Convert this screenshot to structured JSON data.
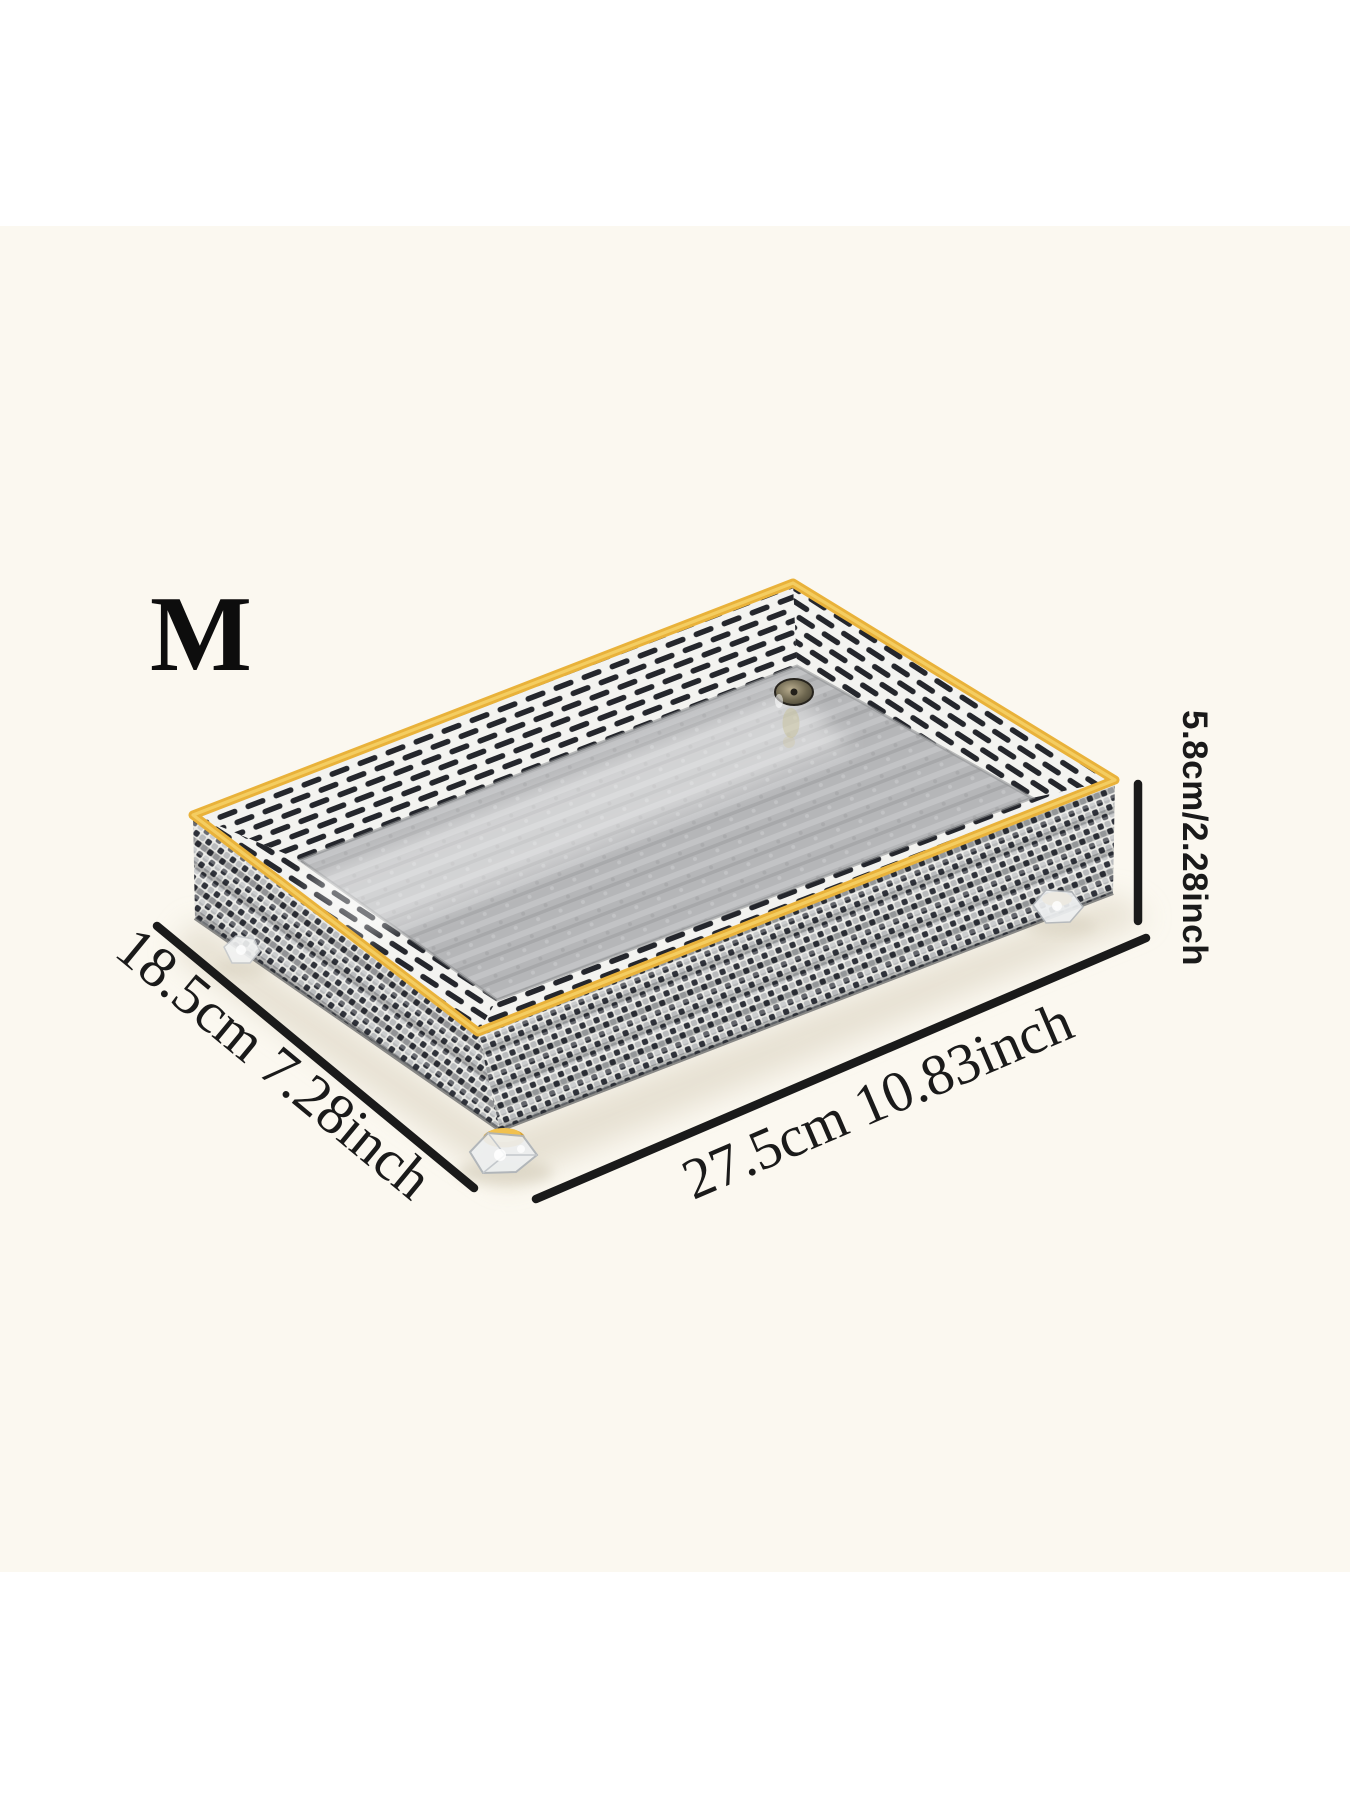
{
  "product": {
    "size_label": "M"
  },
  "dimensions": {
    "depth_label": "18.5cm 7.28inch",
    "width_label": "27.5cm 10.83inch",
    "height_label": "5.8cm/2.28inch"
  },
  "colors": {
    "page_background": "#ffffff",
    "photo_background": "#fbf8f0",
    "gold_trim": "#e9b23a",
    "gold_trim_highlight": "#f5cf66",
    "wall_light": "#e9e9e5",
    "wall_dark": "#2f323a",
    "stripe_dark": "#24262c",
    "stripe_light": "#f3f3f0",
    "interior_gray": "#b5b6b8",
    "annotation_ink": "#1a1a1a"
  }
}
